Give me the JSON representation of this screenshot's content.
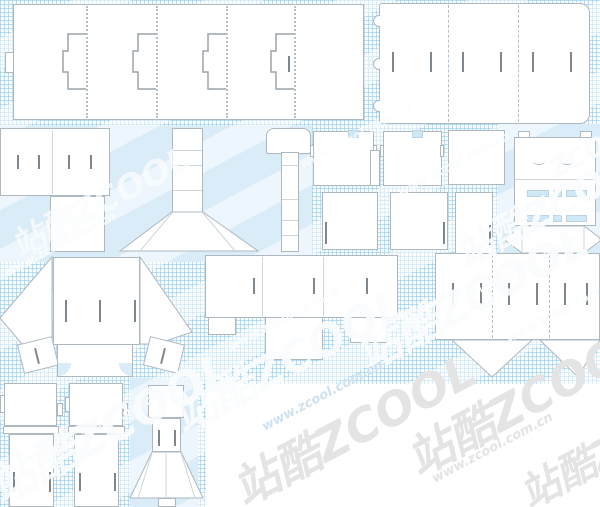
{
  "canvas": {
    "width": 600,
    "height": 507,
    "background_color": "#ffffff",
    "grid_line_color": "#89c7e9",
    "flat_blue_color": "#d9ecf8",
    "dieline_fill": "#ffffff",
    "dieline_stroke": "#aeb9bf",
    "fold_line_color": "#b7c0c5",
    "slit_color": "#7e878d"
  },
  "watermark": {
    "brand": "站酷ZCOOL",
    "brand_en": "ZCOOL",
    "url": "www.zcool.com.cn",
    "color_on_grid": "#ffffff",
    "color_on_white": "#e4e4e4"
  },
  "watermarks": [
    {
      "text": "站酷ZCOOL"
    },
    {
      "text": "www.zcool.com.cn"
    },
    {
      "text": "www.zcool.com.cn"
    },
    {
      "text": "站酷ZCOOL"
    },
    {
      "text": "www.zcool.com.cn"
    },
    {
      "text": "站酷ZCOOL"
    },
    {
      "text": "www.zcool.com.cn"
    },
    {
      "text": "站酷ZCOOL"
    },
    {
      "text": "www.zcool.com.cn"
    },
    {
      "text": "www.zcool.com.cn"
    },
    {
      "text": "站酷ZCOOL"
    },
    {
      "text": "www.zcool.com.cn"
    },
    {
      "text": "站酷ZCOOL"
    },
    {
      "text": "www.zcool.com.cn"
    },
    {
      "text": "站酷ZCOOL"
    },
    {
      "text": "ZCOOL"
    },
    {
      "text": "www.zcool.com.cn"
    },
    {
      "text": "站酷ZCOOL"
    }
  ],
  "templates": [
    {
      "id": "sleeve-long-interlock",
      "bbox": [
        5,
        4,
        359,
        116
      ]
    },
    {
      "id": "trifold-lid-rounded",
      "bbox": [
        373,
        3,
        224,
        121
      ]
    },
    {
      "id": "panel-pair-left",
      "bbox": [
        0,
        128,
        110,
        124
      ]
    },
    {
      "id": "tower-with-skirt",
      "bbox": [
        120,
        128,
        138,
        124
      ]
    },
    {
      "id": "tube-strip-flap",
      "bbox": [
        266,
        128,
        45,
        124
      ]
    },
    {
      "id": "carton-a",
      "bbox": [
        310,
        131,
        70,
        119
      ]
    },
    {
      "id": "carton-b",
      "bbox": [
        380,
        131,
        68,
        119
      ]
    },
    {
      "id": "carton-c",
      "bbox": [
        448,
        130,
        57,
        125
      ]
    },
    {
      "id": "wrap-tray-slotted",
      "bbox": [
        506,
        126,
        94,
        128
      ]
    },
    {
      "id": "fan-carrier",
      "bbox": [
        0,
        257,
        192,
        120
      ]
    },
    {
      "id": "stepped-tray-wide",
      "bbox": [
        205,
        255,
        193,
        105
      ]
    },
    {
      "id": "lid-with-triangles",
      "bbox": [
        435,
        253,
        165,
        125
      ]
    },
    {
      "id": "sleeve-small-a",
      "bbox": [
        0,
        383,
        63,
        124
      ]
    },
    {
      "id": "sleeve-small-b",
      "bbox": [
        65,
        383,
        63,
        124
      ]
    },
    {
      "id": "fan-stand",
      "bbox": [
        130,
        385,
        73,
        122
      ]
    }
  ]
}
